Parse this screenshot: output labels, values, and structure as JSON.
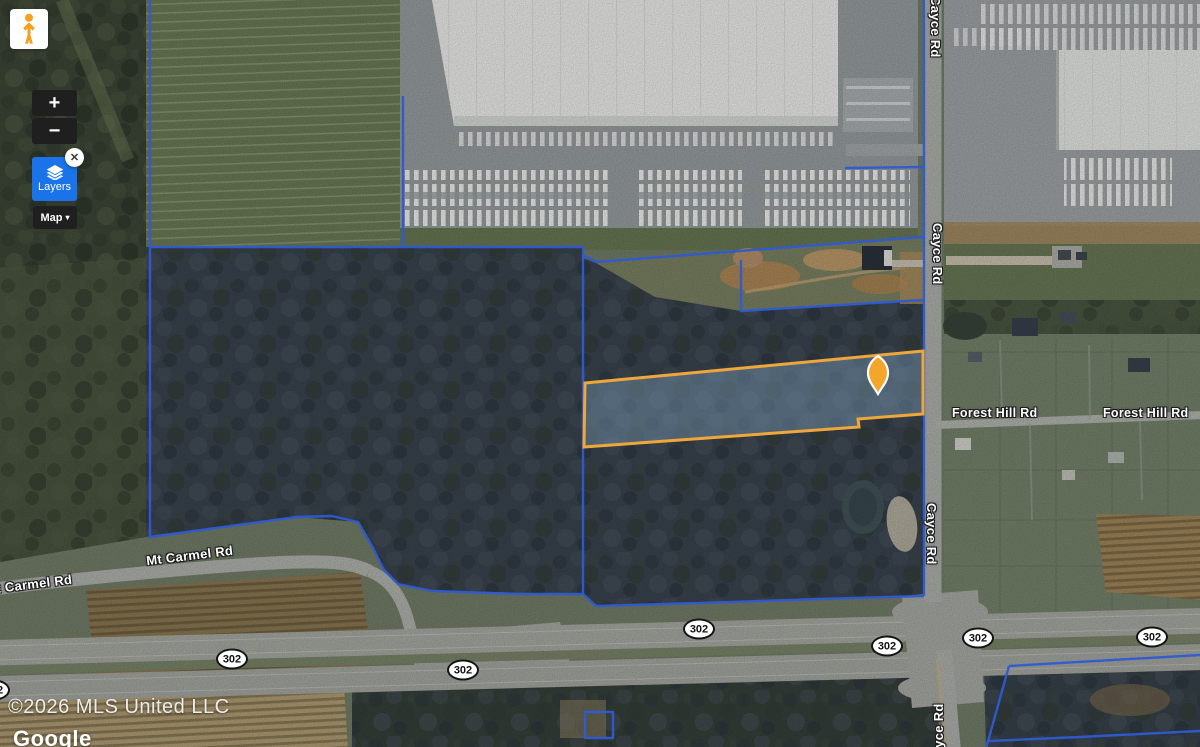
{
  "controls": {
    "pegman_icon": "pegman-icon",
    "zoom_in_label": "+",
    "zoom_out_label": "−",
    "layers_label": "Layers",
    "layers_icon": "layers-icon",
    "close_glyph": "✕",
    "map_type_label": "Map",
    "map_type_caret": "▾"
  },
  "roads": {
    "cayce": "Cayce Rd",
    "forest_hill": "Forest Hill Rd",
    "mt_carmel": "Mt Carmel Rd",
    "route_shield": "302"
  },
  "attribution": {
    "copyright": "©2026 MLS United LLC",
    "brand": "Google"
  },
  "overlay": {
    "boundary_color": "#2F5BD2",
    "parcel_outline_color": "#EFA73C",
    "marker_color": "#F4A62A",
    "layers_button_color": "#1A73E8"
  }
}
